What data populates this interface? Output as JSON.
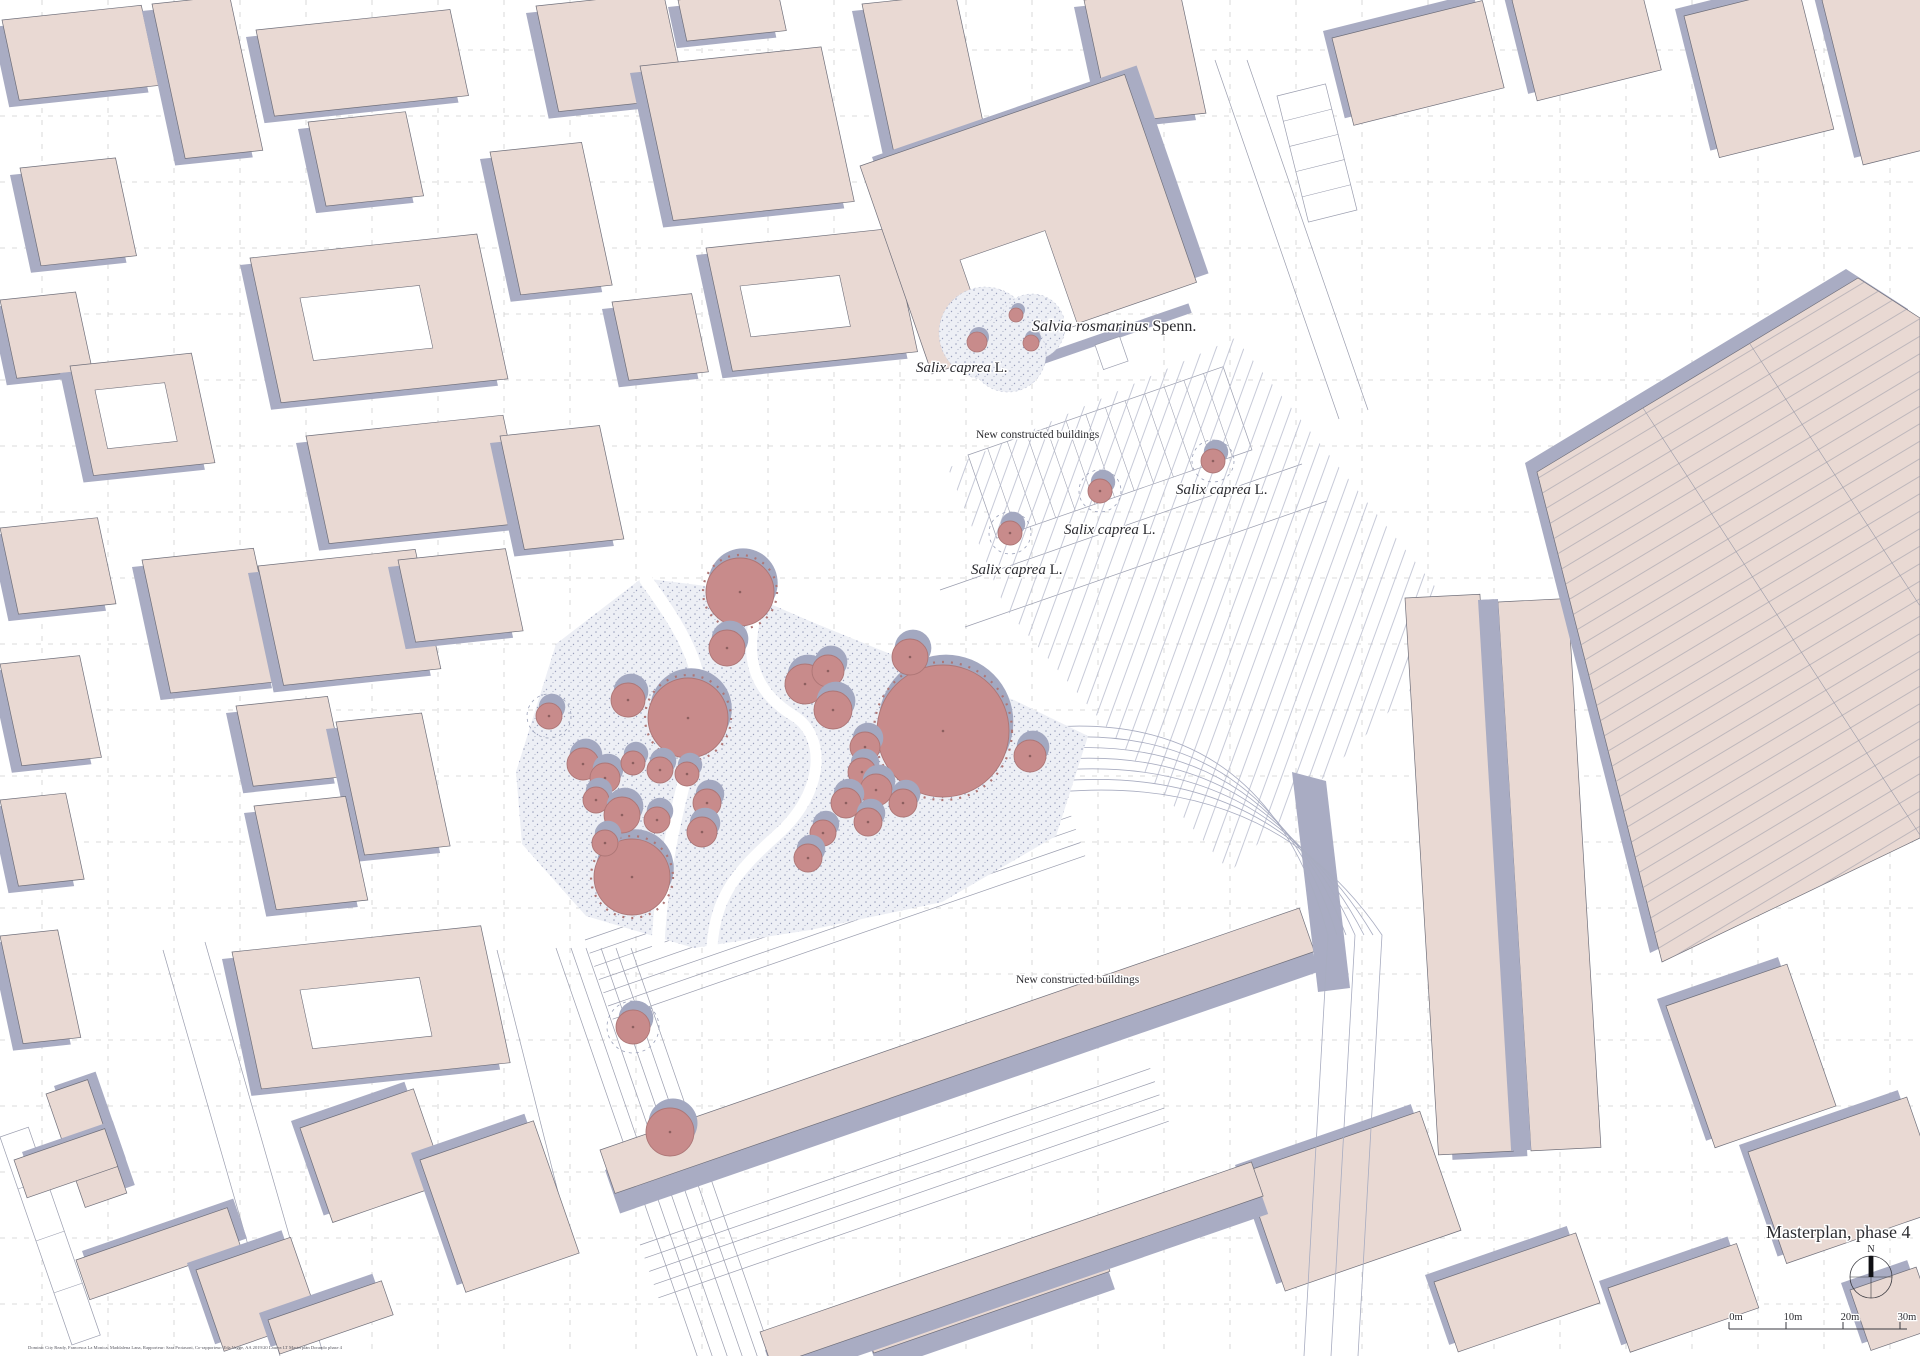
{
  "map": {
    "annotations": {
      "salvia": {
        "species": "Salvia rosmarinus",
        "authority": " Spenn."
      },
      "salix_top": {
        "species": "Salix caprea",
        "authority": " L."
      },
      "new_top": {
        "text": "New constructed buildings"
      },
      "salix_right": {
        "species": "Salix caprea",
        "authority": " L."
      },
      "salix_mid": {
        "species": "Salix caprea",
        "authority": " L."
      },
      "salix_left": {
        "species": "Salix caprea",
        "authority": " L."
      },
      "new_bottom": {
        "text": "New constructed buildings"
      }
    },
    "title_block": {
      "title": "Masterplan, phase 4",
      "north_label": "N"
    },
    "scale_bar": {
      "labels": [
        "0m",
        "10m",
        "20m",
        "30m"
      ],
      "tick_x": [
        1729,
        1786,
        1843,
        1900
      ],
      "bar_end_x": 1907,
      "bar_y": 1329,
      "label_y": 1320
    },
    "credits": "Dominic City Ready, Francesca La Monica, Maddalena Lana, Rapporteur: Sara Protasoni, Co-rapporteur: Eda Vagge, AA 2019/20 Laurea LT Masterplan Dorando phase 4",
    "colors": {
      "background": "#ffffff",
      "building_fill": "#e9d9d3",
      "building_stroke": "#6f6f7a",
      "shadow": "#a9acc3",
      "tree_fill": "#c88b8b",
      "tree_stroke": "#ad7676",
      "tree_center": "#8d5f5f",
      "tree_shadow": "#a3a8c0",
      "park_ground": "#edeff5",
      "stipple_dot": "#9aa0bc",
      "paving_line": "#b9bdce",
      "curve_line": "#a8acc0",
      "plot_line": "#9a9dae",
      "grid_line": "#cfcfcf",
      "text": "#2b2b30"
    },
    "planting": {
      "trees_large": [
        {
          "x": 688,
          "y": 718,
          "r": 40
        },
        {
          "x": 943,
          "y": 731,
          "r": 66
        },
        {
          "x": 632,
          "y": 877,
          "r": 38
        },
        {
          "x": 740,
          "y": 592,
          "r": 34
        }
      ],
      "trees_small": [
        {
          "x": 628,
          "y": 700,
          "r": 17
        },
        {
          "x": 583,
          "y": 764,
          "r": 16
        },
        {
          "x": 605,
          "y": 778,
          "r": 15
        },
        {
          "x": 633,
          "y": 763,
          "r": 12
        },
        {
          "x": 660,
          "y": 770,
          "r": 13
        },
        {
          "x": 687,
          "y": 774,
          "r": 12
        },
        {
          "x": 596,
          "y": 800,
          "r": 13
        },
        {
          "x": 622,
          "y": 815,
          "r": 18
        },
        {
          "x": 657,
          "y": 820,
          "r": 13
        },
        {
          "x": 605,
          "y": 843,
          "r": 13
        },
        {
          "x": 707,
          "y": 803,
          "r": 14
        },
        {
          "x": 702,
          "y": 832,
          "r": 15
        },
        {
          "x": 727,
          "y": 648,
          "r": 18
        },
        {
          "x": 805,
          "y": 684,
          "r": 20
        },
        {
          "x": 828,
          "y": 671,
          "r": 16
        },
        {
          "x": 833,
          "y": 710,
          "r": 19
        },
        {
          "x": 865,
          "y": 747,
          "r": 15
        },
        {
          "x": 862,
          "y": 772,
          "r": 14
        },
        {
          "x": 876,
          "y": 790,
          "r": 16
        },
        {
          "x": 846,
          "y": 803,
          "r": 15
        },
        {
          "x": 868,
          "y": 822,
          "r": 14
        },
        {
          "x": 823,
          "y": 833,
          "r": 13
        },
        {
          "x": 808,
          "y": 858,
          "r": 14
        },
        {
          "x": 903,
          "y": 803,
          "r": 14
        },
        {
          "x": 1030,
          "y": 756,
          "r": 16
        },
        {
          "x": 910,
          "y": 657,
          "r": 18
        },
        {
          "x": 670,
          "y": 1132,
          "r": 24
        }
      ],
      "trees_ringed": [
        {
          "x": 549,
          "y": 716,
          "r": 13
        },
        {
          "x": 633,
          "y": 1027,
          "r": 17
        },
        {
          "x": 1010,
          "y": 533,
          "r": 12
        },
        {
          "x": 1100,
          "y": 491,
          "r": 12
        },
        {
          "x": 1213,
          "y": 461,
          "r": 12
        }
      ],
      "shrub_beds": [
        {
          "x": 985,
          "y": 333,
          "r": 46
        },
        {
          "x": 1032,
          "y": 327,
          "r": 33
        },
        {
          "x": 1008,
          "y": 354,
          "r": 38
        }
      ],
      "shrub_dots": [
        {
          "x": 977,
          "y": 342,
          "r": 10
        },
        {
          "x": 1016,
          "y": 315,
          "r": 7
        },
        {
          "x": 1031,
          "y": 343,
          "r": 8
        }
      ]
    }
  }
}
